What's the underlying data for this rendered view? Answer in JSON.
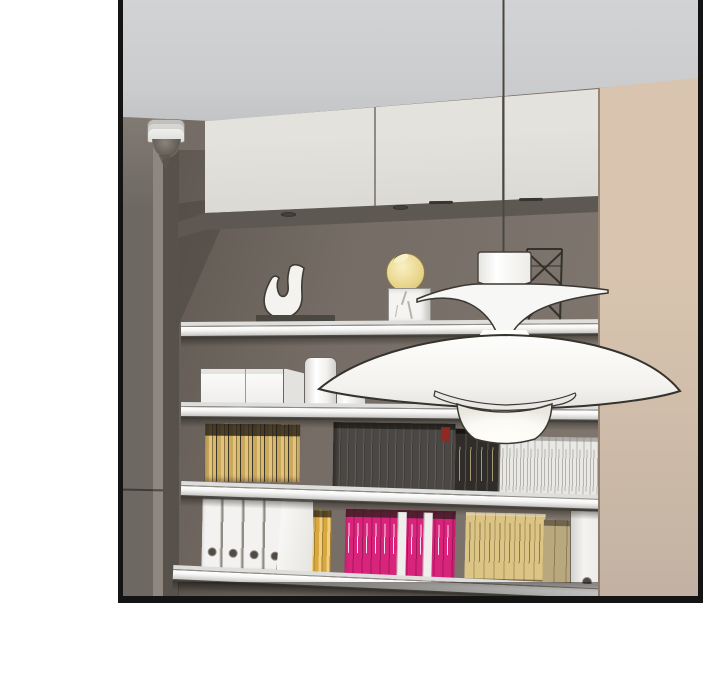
{
  "panel": {
    "kind": "webtoon-comic-panel",
    "description": "3D-rendered interior scene: built-in shelving niche with cream upper cabinets, taupe back wall, four metal-edged shelves holding books and decor, white PH5-style pendant lamp hanging on a cord, dome security camera at upper left, tall beige panel at right",
    "text_content_visible": "none"
  },
  "scene": {
    "shelf_count": 4,
    "items_top_row": [
      "white horseshoe sculpture on dark base",
      "yellow sphere vase on white marble cube",
      "black wireframe ornament"
    ],
    "items_second_row": [
      "white two-part storage box",
      "white canister",
      "low white canister"
    ],
    "books_third_row": [
      "thin gold books with dark tops",
      "charcoal books",
      "black books with beige spine text",
      "white books with fine spine text",
      "small red spine label"
    ],
    "books_bottom_row": [
      "four white ring binders with finger holes",
      "tilted white binder flap",
      "gold striped books",
      "magenta books with white spine text and two white spines",
      "tan art books with spine text",
      "dark tan books",
      "white binder with finger hole"
    ],
    "lamp": "white layered pendant (cap, upper saucer, wide dome shade, lower saucer, glowing bottom cone) on thin cord",
    "camera": "white dome security camera with gray dome",
    "binder_holes": 4
  },
  "palette": {
    "page": "#ffffff",
    "border": "#141414",
    "ceiling": "#cbccce",
    "cabinet": "#e4e2dd",
    "cabinetSeam": "#8f8b83",
    "soffit": "#5d5852",
    "wall": "#756d65",
    "wallDark": "#5e5750",
    "leftPanel": "#6e6862",
    "leftPanelLight": "#8e877f",
    "leftPanelDark": "#56514b",
    "beige": "#d9c5af",
    "beigeDeep": "#c3b2a3",
    "shelfLip": "#dededd",
    "shelfFaceLight": "#f6f6f5",
    "shelfFaceDark": "#bfbebb",
    "outline": "#3a3631",
    "lampWhite": "#f8f8f6",
    "lampGlow": "#fffef6",
    "charcoalBook": "#4b4744",
    "blackBook": "#2f2c29",
    "whiteBook": "#e9e8e5",
    "pinkBook": "#d8247b",
    "tanBook": "#dcc584",
    "tanBookDark": "#b9a87e",
    "binder": "#f3f2f0",
    "sphere": "#ead78f",
    "marble": "#f5f4f2"
  }
}
